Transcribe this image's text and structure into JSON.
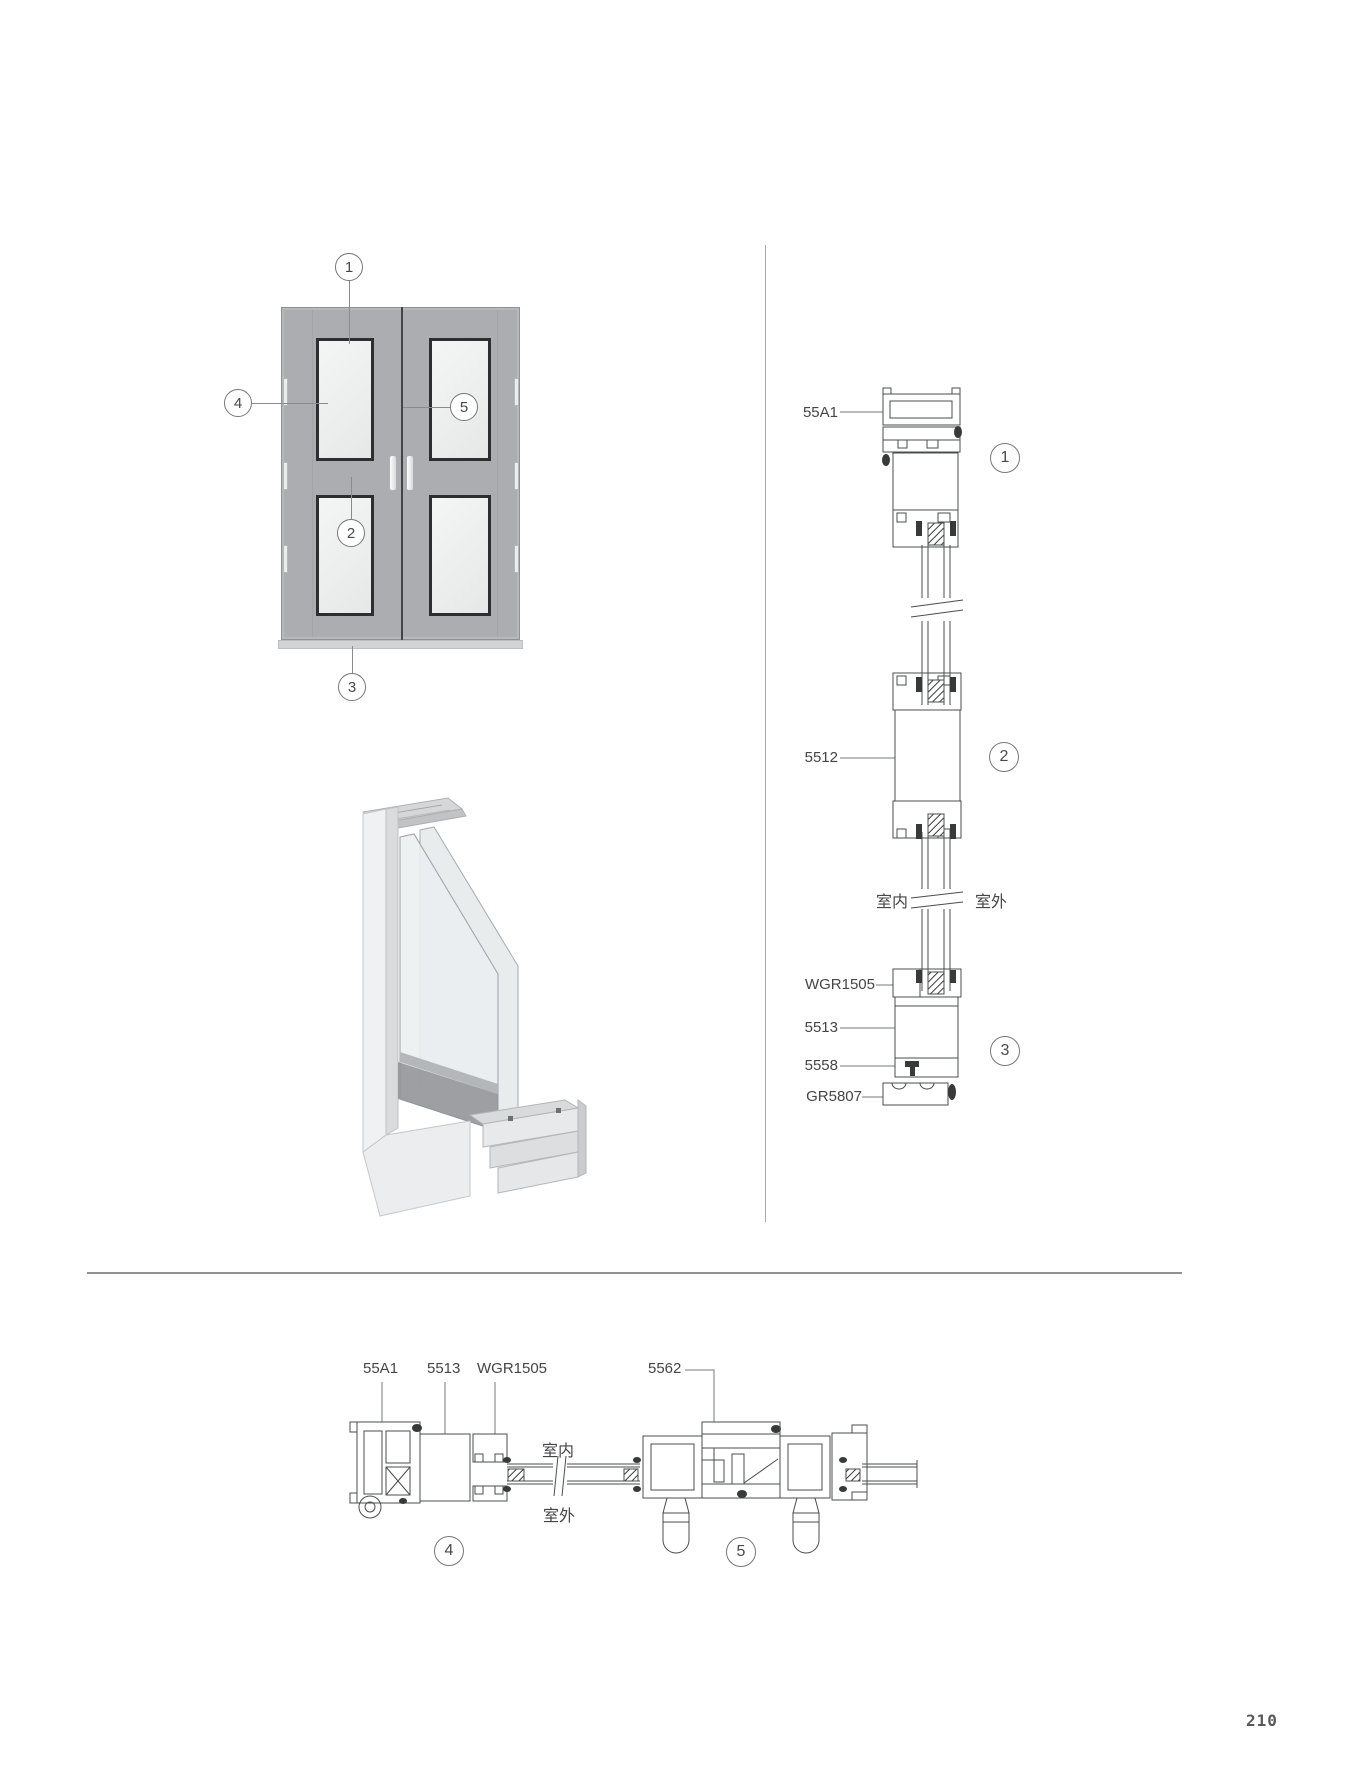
{
  "page": {
    "number": "210"
  },
  "colors": {
    "door_gray": "#abadb0",
    "glass_light": "#f1f2f2",
    "bead_dark": "#2d2e30",
    "line": "#4b4c4e",
    "divider": "#909193"
  },
  "elevation": {
    "description": "double door elevation",
    "callouts": {
      "c1": "1",
      "c2": "2",
      "c3": "3",
      "c4": "4",
      "c5": "5"
    }
  },
  "vertical_section": {
    "codes": {
      "a55a1": "55A1",
      "a5512": "5512",
      "awgr1505": "WGR1505",
      "a5513": "5513",
      "a5558": "5558",
      "agr5807": "GR5807"
    },
    "indoor": "室内",
    "outdoor": "室外",
    "callouts": {
      "c1": "1",
      "c2": "2",
      "c3": "3"
    }
  },
  "horizontal_section": {
    "codes": {
      "a55a1": "55A1",
      "a5513": "5513",
      "awgr1505": "WGR1505",
      "a5562": "5562"
    },
    "indoor": "室内",
    "outdoor": "室外",
    "callouts": {
      "c4": "4",
      "c5": "5"
    }
  }
}
